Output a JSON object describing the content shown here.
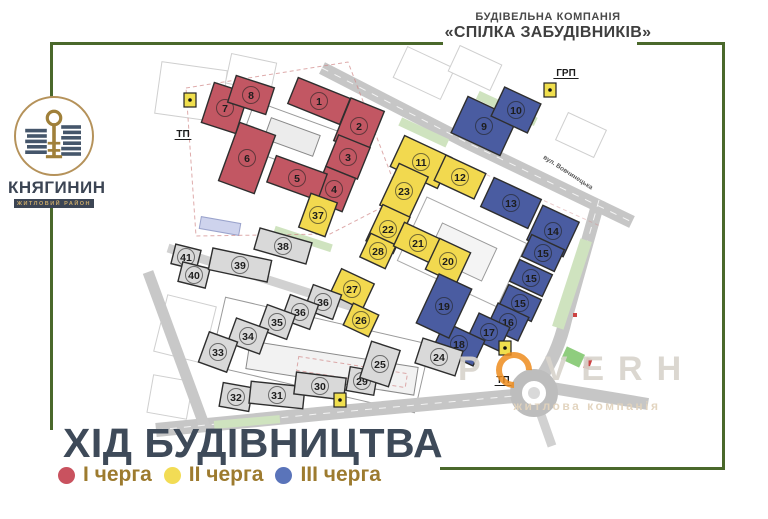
{
  "header": {
    "line1": "БУДІВЕЛЬНА КОМПАНІЯ",
    "line2": "«СПІЛКА ЗАБУДІВНИКІВ»"
  },
  "logo": {
    "name": "КНЯГИНИН",
    "subtitle": "житловий район"
  },
  "title": "ХІД БУДІВНИЦТВА",
  "legend": [
    {
      "label": "І черга",
      "color": "#c9525f"
    },
    {
      "label": "ІІ черга",
      "color": "#f2dc55"
    },
    {
      "label": "ІІІ черга",
      "color": "#5a74ba"
    }
  ],
  "watermark": {
    "word_start": "P",
    "word_end": "VERH",
    "subtitle": "житлова компанія"
  },
  "map": {
    "phase_colors": {
      "p1": "#c25763",
      "p2": "#f2d94f",
      "p3": "#4a5ca1",
      "p0": "#d9d9d9"
    },
    "labels": [
      {
        "text": "ТП",
        "x": 183,
        "y": 137
      },
      {
        "text": "ГРП",
        "x": 566,
        "y": 76
      },
      {
        "text": "ТП",
        "x": 503,
        "y": 383
      }
    ],
    "street": {
      "text": "вул. Вовчинецька",
      "x": 567,
      "y": 174,
      "rotate": 33
    },
    "utilities": [
      {
        "x": 190,
        "y": 100
      },
      {
        "x": 550,
        "y": 90
      },
      {
        "x": 505,
        "y": 348
      },
      {
        "x": 340,
        "y": 400
      }
    ],
    "buildings": [
      {
        "n": "1",
        "p": "p1",
        "x": 319,
        "y": 101,
        "w": 56,
        "h": 28,
        "r": 22
      },
      {
        "n": "2",
        "p": "p1",
        "x": 359,
        "y": 126,
        "w": 36,
        "h": 46,
        "r": 22
      },
      {
        "n": "3",
        "p": "p1",
        "x": 348,
        "y": 157,
        "w": 34,
        "h": 34,
        "r": 22
      },
      {
        "n": "4",
        "p": "p1",
        "x": 334,
        "y": 189,
        "w": 32,
        "h": 36,
        "r": 22
      },
      {
        "n": "5",
        "p": "p1",
        "x": 297,
        "y": 178,
        "w": 54,
        "h": 28,
        "r": 20
      },
      {
        "n": "6",
        "p": "p1",
        "x": 247,
        "y": 158,
        "w": 38,
        "h": 62,
        "r": 20
      },
      {
        "n": "7",
        "p": "p1",
        "x": 225,
        "y": 108,
        "w": 36,
        "h": 42,
        "r": 18
      },
      {
        "n": "8",
        "p": "p1",
        "x": 251,
        "y": 95,
        "w": 40,
        "h": 28,
        "r": 18
      },
      {
        "n": "37",
        "p": "p2",
        "x": 318,
        "y": 215,
        "w": 28,
        "h": 36,
        "r": 20
      },
      {
        "n": "11",
        "p": "p2",
        "x": 421,
        "y": 162,
        "w": 52,
        "h": 34,
        "r": 25
      },
      {
        "n": "12",
        "p": "p2",
        "x": 460,
        "y": 177,
        "w": 44,
        "h": 28,
        "r": 25
      },
      {
        "n": "23",
        "p": "p2",
        "x": 404,
        "y": 191,
        "w": 32,
        "h": 46,
        "r": 25
      },
      {
        "n": "22",
        "p": "p2",
        "x": 388,
        "y": 229,
        "w": 30,
        "h": 40,
        "r": 25
      },
      {
        "n": "28",
        "p": "p2",
        "x": 378,
        "y": 251,
        "w": 28,
        "h": 26,
        "r": 25
      },
      {
        "n": "21",
        "p": "p2",
        "x": 418,
        "y": 243,
        "w": 42,
        "h": 26,
        "r": 25
      },
      {
        "n": "20",
        "p": "p2",
        "x": 448,
        "y": 261,
        "w": 34,
        "h": 34,
        "r": 25
      },
      {
        "n": "27",
        "p": "p2",
        "x": 352,
        "y": 289,
        "w": 36,
        "h": 28,
        "r": 25
      },
      {
        "n": "26",
        "p": "p2",
        "x": 361,
        "y": 320,
        "w": 28,
        "h": 24,
        "r": 25
      },
      {
        "n": "9",
        "p": "p3",
        "x": 484,
        "y": 126,
        "w": 54,
        "h": 40,
        "r": 25
      },
      {
        "n": "10",
        "p": "p3",
        "x": 516,
        "y": 110,
        "w": 40,
        "h": 32,
        "r": 25
      },
      {
        "n": "13",
        "p": "p3",
        "x": 511,
        "y": 203,
        "w": 52,
        "h": 32,
        "r": 25
      },
      {
        "n": "14",
        "p": "p3",
        "x": 553,
        "y": 231,
        "w": 40,
        "h": 38,
        "r": 25
      },
      {
        "n": "15",
        "p": "p3",
        "x": 543,
        "y": 253,
        "w": 36,
        "h": 24,
        "r": 25
      },
      {
        "n": "15",
        "p": "p3",
        "x": 531,
        "y": 278,
        "w": 36,
        "h": 24,
        "r": 25
      },
      {
        "n": "15",
        "p": "p3",
        "x": 520,
        "y": 303,
        "w": 36,
        "h": 24,
        "r": 25
      },
      {
        "n": "16",
        "p": "p3",
        "x": 508,
        "y": 322,
        "w": 34,
        "h": 26,
        "r": 25
      },
      {
        "n": "17",
        "p": "p3",
        "x": 489,
        "y": 332,
        "w": 34,
        "h": 26,
        "r": 25
      },
      {
        "n": "18",
        "p": "p3",
        "x": 459,
        "y": 344,
        "w": 44,
        "h": 28,
        "r": 25
      },
      {
        "n": "19",
        "p": "p3",
        "x": 444,
        "y": 306,
        "w": 36,
        "h": 54,
        "r": 25
      },
      {
        "n": "41",
        "p": "p0",
        "x": 186,
        "y": 257,
        "w": 26,
        "h": 20,
        "r": 14
      },
      {
        "n": "40",
        "p": "p0",
        "x": 194,
        "y": 275,
        "w": 28,
        "h": 20,
        "r": 14
      },
      {
        "n": "39",
        "p": "p0",
        "x": 240,
        "y": 265,
        "w": 60,
        "h": 22,
        "r": 12
      },
      {
        "n": "38",
        "p": "p0",
        "x": 283,
        "y": 246,
        "w": 54,
        "h": 22,
        "r": 16
      },
      {
        "n": "36",
        "p": "p0",
        "x": 323,
        "y": 302,
        "w": 30,
        "h": 26,
        "r": 20
      },
      {
        "n": "36",
        "p": "p0",
        "x": 300,
        "y": 312,
        "w": 30,
        "h": 26,
        "r": 20
      },
      {
        "n": "35",
        "p": "p0",
        "x": 277,
        "y": 322,
        "w": 30,
        "h": 26,
        "r": 20
      },
      {
        "n": "34",
        "p": "p0",
        "x": 248,
        "y": 336,
        "w": 34,
        "h": 26,
        "r": 20
      },
      {
        "n": "33",
        "p": "p0",
        "x": 218,
        "y": 352,
        "w": 30,
        "h": 32,
        "r": 20
      },
      {
        "n": "32",
        "p": "p0",
        "x": 236,
        "y": 397,
        "w": 30,
        "h": 24,
        "r": 10
      },
      {
        "n": "31",
        "p": "p0",
        "x": 277,
        "y": 395,
        "w": 54,
        "h": 22,
        "r": 6
      },
      {
        "n": "30",
        "p": "p0",
        "x": 320,
        "y": 386,
        "w": 50,
        "h": 22,
        "r": 7
      },
      {
        "n": "29",
        "p": "p0",
        "x": 362,
        "y": 381,
        "w": 28,
        "h": 24,
        "r": 10
      },
      {
        "n": "25",
        "p": "p0",
        "x": 380,
        "y": 364,
        "w": 30,
        "h": 38,
        "r": 18
      },
      {
        "n": "24",
        "p": "p0",
        "x": 439,
        "y": 357,
        "w": 42,
        "h": 26,
        "r": 18
      }
    ]
  }
}
